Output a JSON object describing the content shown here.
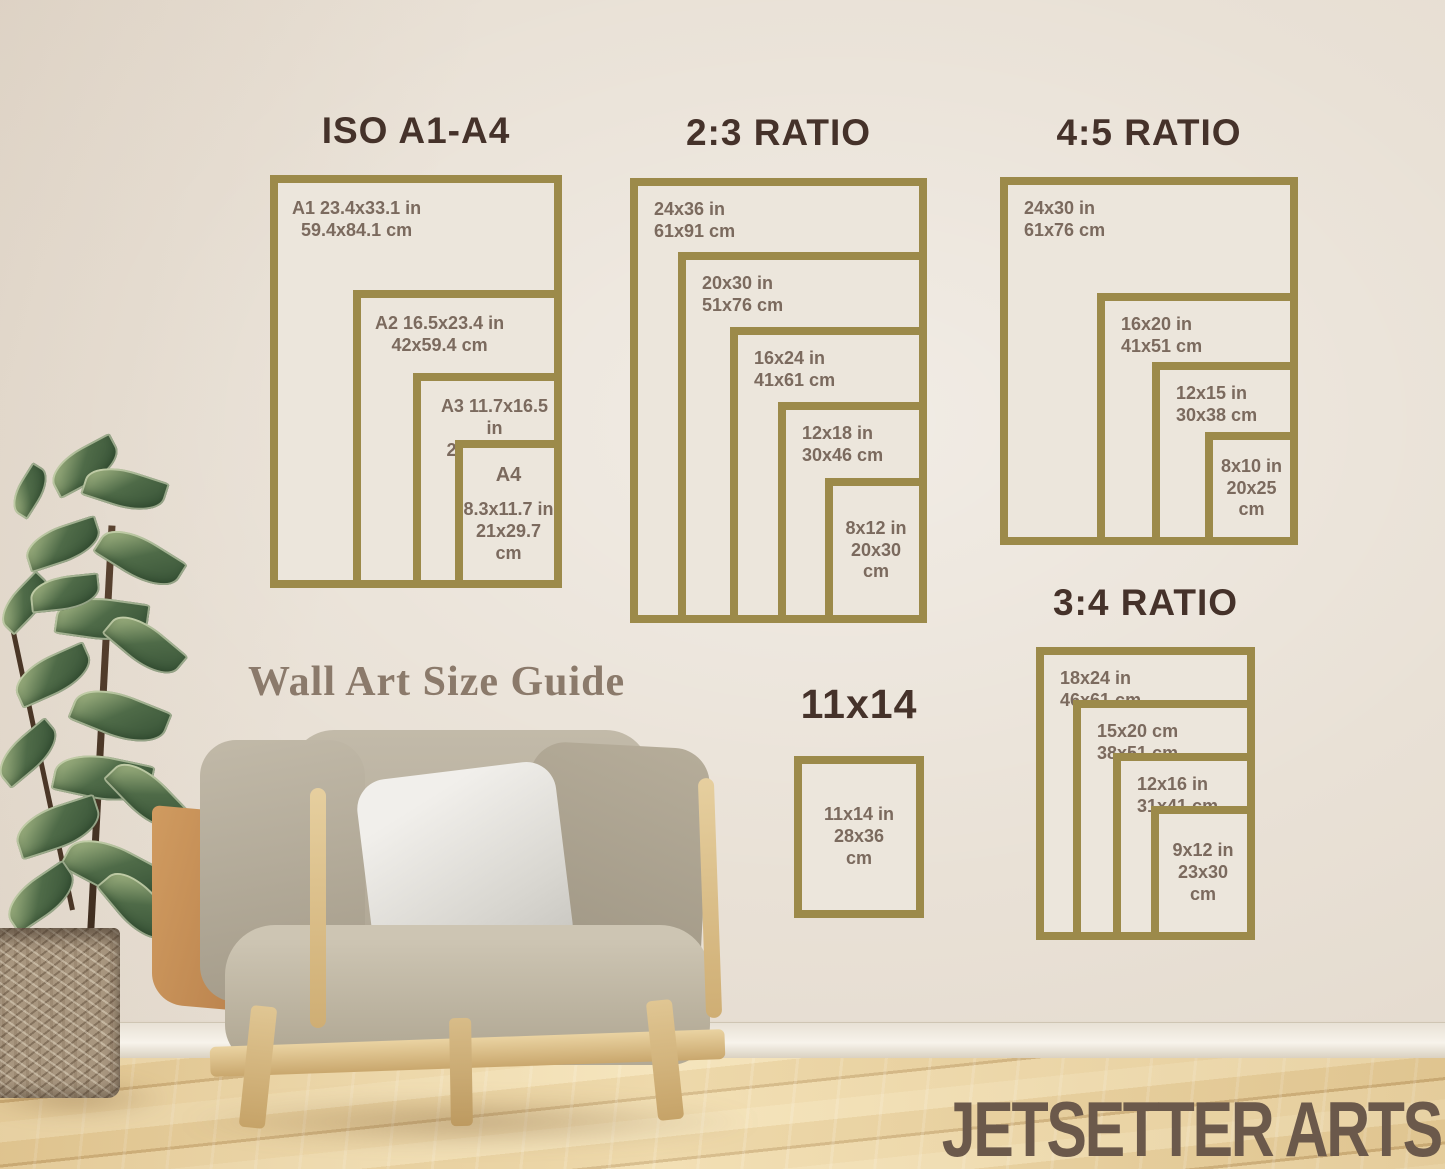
{
  "watermark": "Wall Art Size Guide",
  "brand": "JETSETTER ARTS",
  "colors": {
    "frame_gold": "#9c8a4a",
    "title_brown": "#45322a",
    "size_text": "#7b6a5e",
    "wall_cream": "#e9e1d6",
    "floor_wood": "#e8d09c",
    "brand_brown": "#6b594b"
  },
  "groups": {
    "iso": {
      "title": "ISO A1-A4",
      "frames": [
        {
          "lines": [
            "A1 23.4x33.1 in",
            "59.4x84.1 cm"
          ]
        },
        {
          "lines": [
            "A2 16.5x23.4 in",
            "42x59.4 cm"
          ]
        },
        {
          "lines": [
            "A3 11.7x16.5 in",
            "29.7x42 cm"
          ]
        },
        {
          "lines": [
            "A4",
            "8.3x11.7 in",
            "21x29.7",
            "cm"
          ]
        }
      ]
    },
    "r23": {
      "title": "2:3 RATIO",
      "frames": [
        {
          "lines": [
            "24x36 in",
            "61x91 cm"
          ]
        },
        {
          "lines": [
            "20x30 in",
            "51x76 cm"
          ]
        },
        {
          "lines": [
            "16x24 in",
            "41x61 cm"
          ]
        },
        {
          "lines": [
            "12x18 in",
            "30x46 cm"
          ]
        },
        {
          "lines": [
            "8x12 in",
            "20x30",
            "cm"
          ]
        }
      ]
    },
    "r45": {
      "title": "4:5 RATIO",
      "frames": [
        {
          "lines": [
            "24x30 in",
            "61x76 cm"
          ]
        },
        {
          "lines": [
            "16x20 in",
            "41x51 cm"
          ]
        },
        {
          "lines": [
            "12x15 in",
            "30x38 cm"
          ]
        },
        {
          "lines": [
            "8x10 in",
            "20x25",
            "cm"
          ]
        }
      ]
    },
    "r34": {
      "title": "3:4 RATIO",
      "frames": [
        {
          "lines": [
            "18x24 in",
            "46x61 cm"
          ]
        },
        {
          "lines": [
            "15x20 cm",
            "38x51 cm"
          ]
        },
        {
          "lines": [
            "12x16 in",
            "31x41 cm"
          ]
        },
        {
          "lines": [
            "9x12 in",
            "23x30",
            "cm"
          ]
        }
      ]
    },
    "s1114": {
      "title": "11x14",
      "frames": [
        {
          "lines": [
            "11x14 in",
            "28x36",
            "cm"
          ]
        }
      ]
    }
  }
}
